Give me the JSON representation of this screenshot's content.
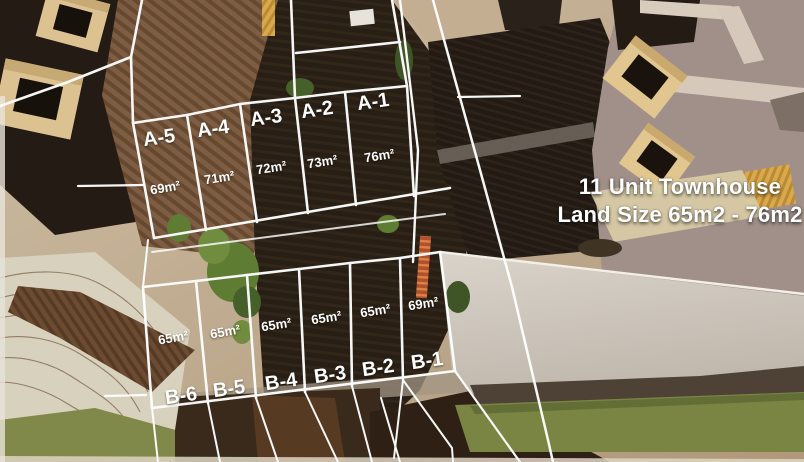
{
  "title": {
    "line1": "11 Unit Townhouse",
    "line2": "Land Size 65m2 - 76m2"
  },
  "lots_a": [
    {
      "name": "A-5",
      "size": "69m²"
    },
    {
      "name": "A-4",
      "size": "71m²"
    },
    {
      "name": "A-3",
      "size": "72m²"
    },
    {
      "name": "A-2",
      "size": "73m²"
    },
    {
      "name": "A-1",
      "size": "76m²"
    }
  ],
  "lots_b": [
    {
      "name": "B-6",
      "size": "65m²"
    },
    {
      "name": "B-5",
      "size": "65m²"
    },
    {
      "name": "B-4",
      "size": "65m²"
    },
    {
      "name": "B-3",
      "size": "65m²"
    },
    {
      "name": "B-2",
      "size": "65m²"
    },
    {
      "name": "B-1",
      "size": "69m²"
    }
  ],
  "colors": {
    "survey_line": "#ffffff",
    "label_text": "#ffffff"
  }
}
